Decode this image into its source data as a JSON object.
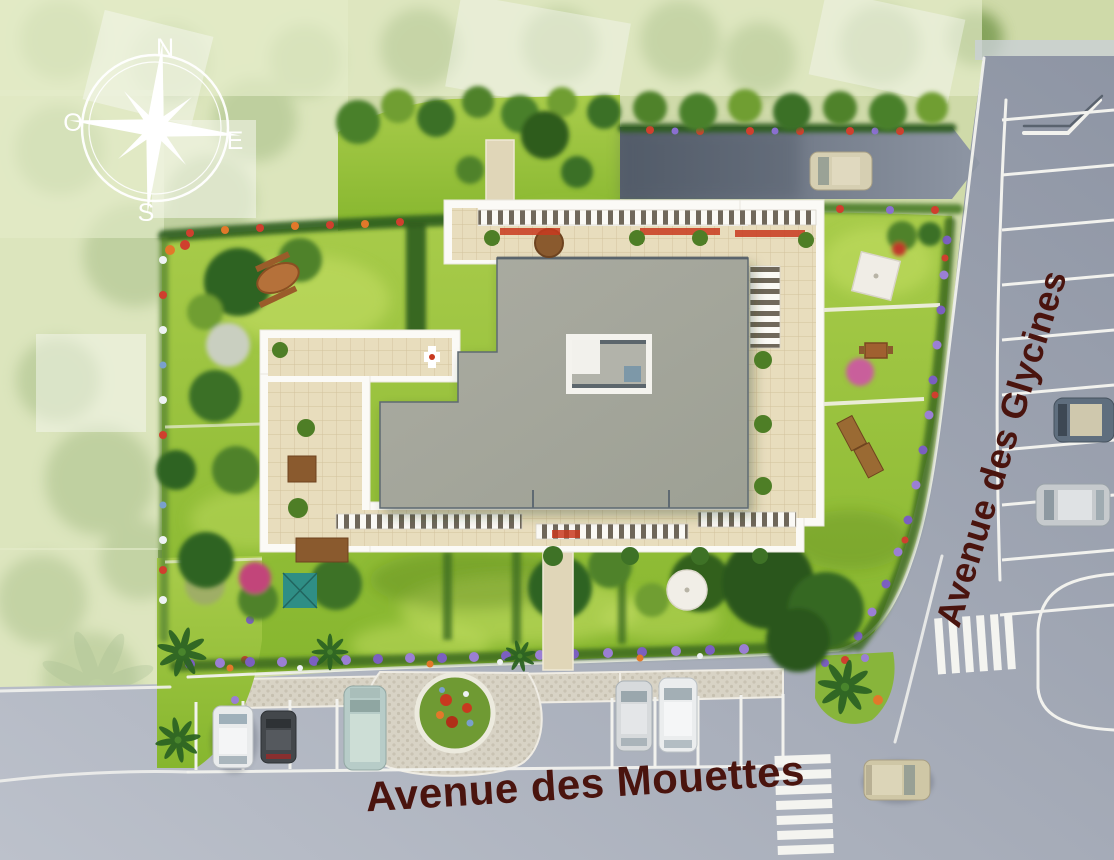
{
  "labels": {
    "street_vertical": "Avenue des Glycines",
    "street_horizontal": "Avenue des Mouettes"
  },
  "compass": {
    "n": "N",
    "e": "E",
    "s": "S",
    "o": "O"
  },
  "colors": {
    "street_label": "#4a140e",
    "road": "#9aa1ae",
    "lawn": "#98c23c",
    "roof": "#a5a79c",
    "terrace_tile": "#e8ddbd",
    "flower_border_purple": "#7b5fc0",
    "compass": "#ffffff"
  }
}
